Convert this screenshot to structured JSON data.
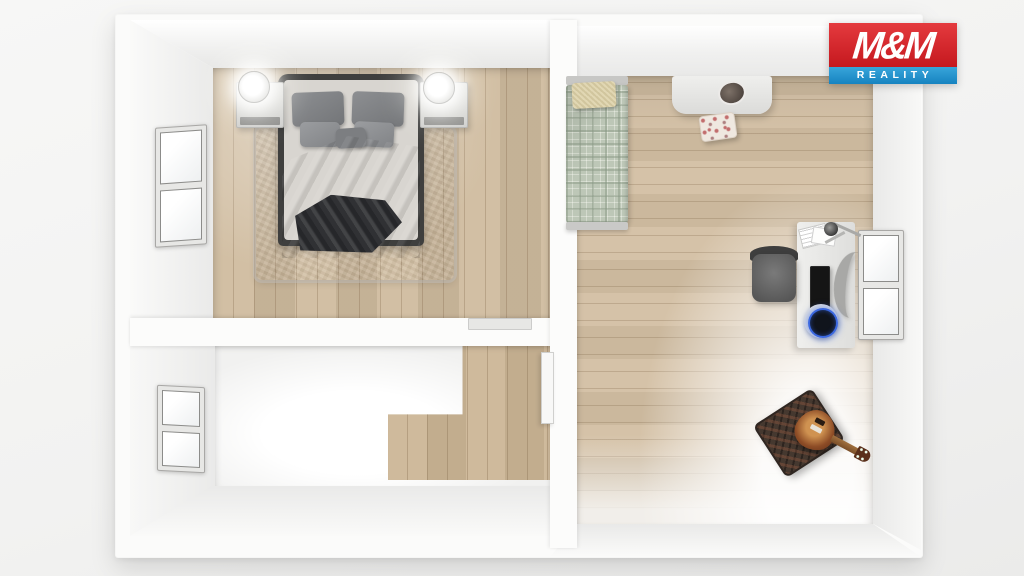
{
  "watermark": {
    "line1": "M&M",
    "line2": "REALITY",
    "colors": {
      "red": "#cf2127",
      "blue": "#2191cd",
      "text": "#ffffff"
    }
  },
  "scene": {
    "description": "3D top-down floor plan render of a two-room apartment with hallway",
    "rooms": [
      {
        "id": "bedroom",
        "position": "top-left",
        "floor": "light-oak-planks-vertical",
        "furniture": [
          "double-bed",
          "dark-duvet",
          "gray-pillows",
          "shag-rug",
          "nightstand-left",
          "nightstand-right",
          "lit-lamp-left",
          "lit-lamp-right",
          "double-window-left-wall",
          "door-threshold"
        ]
      },
      {
        "id": "hallway",
        "position": "bottom-left",
        "floor": "white-tile-with-oak-L-inlay",
        "furniture": [
          "double-window-left-wall",
          "open-door-panel"
        ]
      },
      {
        "id": "living-room",
        "position": "right",
        "floor": "light-oak-planks-horizontal",
        "furniture": [
          "single-bed-sage-plaid",
          "beige-pillow",
          "white-dressing-table",
          "round-mirror-hole",
          "floral-stool",
          "office-chair",
          "white-desk",
          "black-laptop",
          "desk-lamp",
          "papers",
          "curved-monitor",
          "blue-glow-speaker",
          "double-window-right-wall",
          "guitar-amplifier",
          "electric-guitar"
        ]
      }
    ],
    "palette": {
      "wood_floor": "#d0bb9e",
      "wood_plank_line": "#c2ab8a",
      "wall_white": "#fbfbfa",
      "bedding_dark": "#47484b",
      "rug_gray": "#c2bfbd",
      "blanket_sage": "#bdc7b7",
      "pillow_beige": "#dcd0a6",
      "accent_blue_glow": "#3e6eeb"
    }
  }
}
